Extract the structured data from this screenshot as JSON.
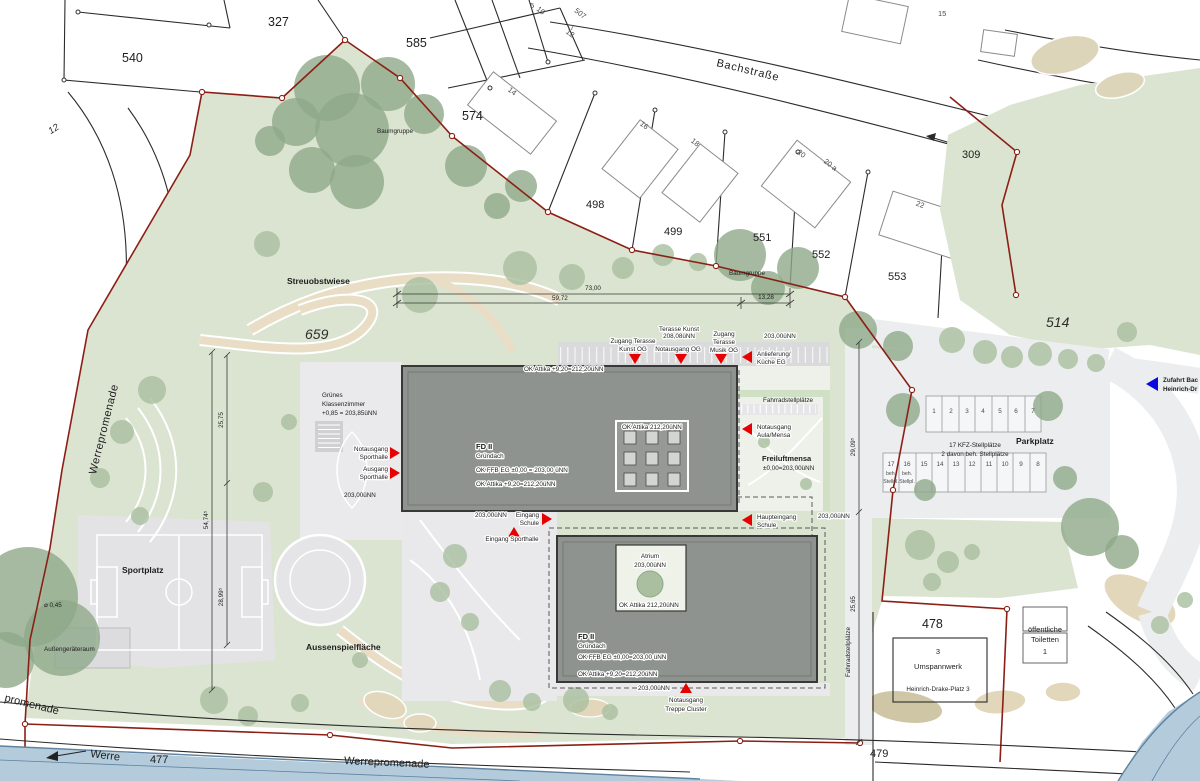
{
  "colors": {
    "site_green": "#dbe4d1",
    "tree_green": "#a9bfa0",
    "tree_dark": "#8ea98a",
    "building_gray": "#8f938f",
    "hardscape_gray": "#e7e7e9",
    "boundary_red": "#8c1f15",
    "entrance_red": "#e60000",
    "river_blue": "#b3cbdb",
    "arrow_blue": "#0a0adf",
    "path_tan": "#e9dec5"
  },
  "parcels": [
    "327",
    "540",
    "585",
    "574",
    "498",
    "499",
    "551",
    "552",
    "553",
    "309",
    "514",
    "659",
    "477",
    "478",
    "479",
    "12"
  ],
  "house_numbers": [
    "5",
    "10",
    "507",
    "7",
    "12",
    "14",
    "16",
    "18",
    "20",
    "20 a",
    "22",
    "15"
  ],
  "streets": {
    "bachstrasse": "Bachstraße",
    "werrepromenade_left": "Werrepromenade",
    "promenade_corner": "promenade",
    "werre": "Werre",
    "werrepromenade_bottom": "Werrepromenade"
  },
  "areas": {
    "streuobstwiese": "Streuobstwiese",
    "baumgruppe": "Baumgruppe",
    "sportplatz": "Sportplatz",
    "aussengeraeteraum": "Außengeräteraum",
    "durchmesser": "⌀ 0,45",
    "aussenspielflaeche": "Aussenspielfläche",
    "gruenes_klassenzimmer": [
      "Grünes",
      "Klassenzimmer",
      "+0,85 = 203,85üNN"
    ],
    "parkplatz": "Parkplatz",
    "kfz": [
      "17 KFZ-Stellplätze",
      "2 davon beh. Stellplätze"
    ],
    "freiluftmensa": [
      "Freiluftmensa",
      "±0,00=203,00üNN"
    ],
    "fahrradstellplaetze": "Fahrradstellplätze",
    "toiletten": [
      "öffentliche",
      "Toiletten",
      "1"
    ],
    "umspannwerk": [
      "3",
      "Umspannwerk",
      "Heinrich-Drake-Platz 3"
    ],
    "zufahrt": [
      "Zufahrt Bac",
      "Heinrich-Dr"
    ],
    "atrium": [
      "Atrium",
      "203,00üNN"
    ]
  },
  "levels": {
    "l203": "203,00üNN",
    "attika_flat": "OK Attika 212,20üNN",
    "terasse": [
      "Terasse Kunst",
      "208,08üNN"
    ]
  },
  "buildings": {
    "north": {
      "name": "FD II",
      "roof": "Gründach",
      "ffb": "OK FFB EG ±0,00 = 203,00 üNN",
      "attika": "OK Attika +9,20=212,20üNN"
    },
    "south": {
      "name": "FD II",
      "roof": "Gründach",
      "ffb": "OK FFB EG ±0,00=203,00 üNN",
      "attika": "OK Attika +9,20=212,20üNN"
    }
  },
  "entrances": {
    "zugang_kunst": [
      "Zugang Terasse",
      "Kunst OG"
    ],
    "notausgang_og": "Notausgang OG",
    "zugang_musik": [
      "Zugang",
      "Terasse",
      "Musik OG"
    ],
    "anlieferung": [
      "Anlieferung/",
      "Küche EG"
    ],
    "notausgang_aula": [
      "Notausgang",
      "Aula/Mensa"
    ],
    "haupteingang": [
      "Haupteingang",
      "Schule"
    ],
    "notausgang_sporthalle": [
      "Notausgang",
      "Sporthalle"
    ],
    "ausgang_sporthalle": [
      "Ausgang",
      "Sporthalle"
    ],
    "eingang_schule": [
      "Eingang",
      "Schule"
    ],
    "eingang_sporthalle": "Eingang Sporthalle",
    "notausgang_treppe": [
      "Notausgang",
      "Treppe Cluster"
    ]
  },
  "dimensions": {
    "d73": "73,00",
    "d59": "59,72",
    "d13": "13,28",
    "d2575": "25,75",
    "d5474": "54,74⁵",
    "d2899": "28,99⁵",
    "d2909": "29,09⁵",
    "d2565": "25,65"
  },
  "parking": {
    "row_top": [
      "1",
      "2",
      "3",
      "4",
      "5",
      "6",
      "7"
    ],
    "row_bottom": [
      "17",
      "16",
      "15",
      "14",
      "13",
      "12",
      "11",
      "10",
      "9",
      "8"
    ],
    "beh_label": "beh.",
    "stellpl_label": "Stellpl."
  }
}
